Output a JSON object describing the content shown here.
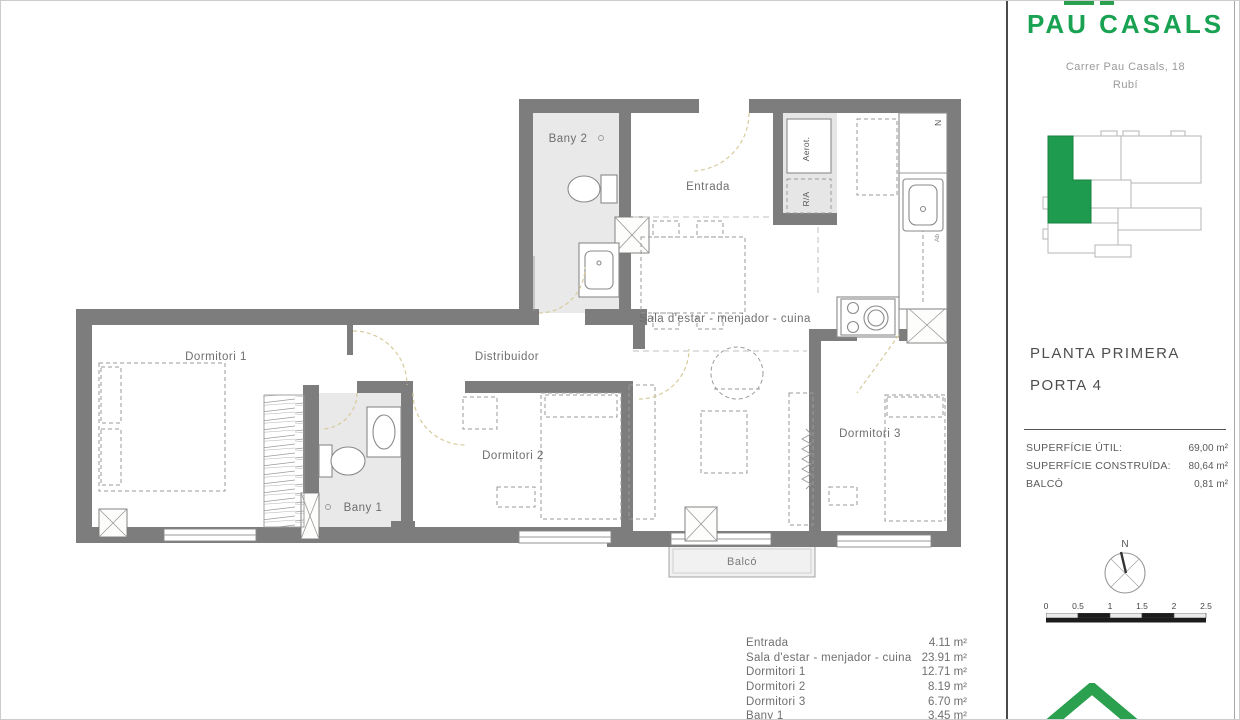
{
  "header": {
    "title": "PAU CASALS",
    "address_line1": "Carrer Pau Casals, 18",
    "address_line2": "Rubí"
  },
  "info": {
    "floor": "PLANTA PRIMERA",
    "door": "PORTA 4"
  },
  "surfaces": {
    "rows": [
      {
        "label": "SUPERFÍCIE ÚTIL:",
        "value": "69,00 m²"
      },
      {
        "label": "SUPERFÍCIE CONSTRUÏDA:",
        "value": "80,64 m²"
      },
      {
        "label": "BALCÓ",
        "value": "0,81 m²"
      }
    ]
  },
  "areas": {
    "rows": [
      {
        "label": "Entrada",
        "value": "4.11 m²"
      },
      {
        "label": "Sala d'estar - menjador - cuina",
        "value": "23.91 m²"
      },
      {
        "label": "Dormitori 1",
        "value": "12.71 m²"
      },
      {
        "label": "Dormitori 2",
        "value": "8.19 m²"
      },
      {
        "label": "Dormitori 3",
        "value": "6.70 m²"
      },
      {
        "label": "Bany 1",
        "value": "3.45 m²"
      }
    ]
  },
  "plan": {
    "labels": {
      "bany2": "Bany 2",
      "entrada": "Entrada",
      "sala": "Sala d'estar - menjador - cuina",
      "distribuidor": "Distribuidor",
      "dormitori1": "Dormitori 1",
      "dormitori2": "Dormitori 2",
      "dormitori3": "Dormitori 3",
      "bany1": "Bany 1",
      "balco": "Balcó",
      "aerot": "Aerot.",
      "ra": "R/A",
      "nevera": "N",
      "ab": "Ab"
    }
  },
  "compass": {
    "north": "N"
  },
  "scalebar": {
    "ticks": [
      "0",
      "0.5",
      "1",
      "1.5",
      "2",
      "2.5"
    ]
  },
  "colors": {
    "brand_green": "#18a251",
    "keyplan_green": "#1f9b50",
    "wall_gray": "#7d7d7d",
    "door_arc_tan": "#d6cb9b"
  }
}
